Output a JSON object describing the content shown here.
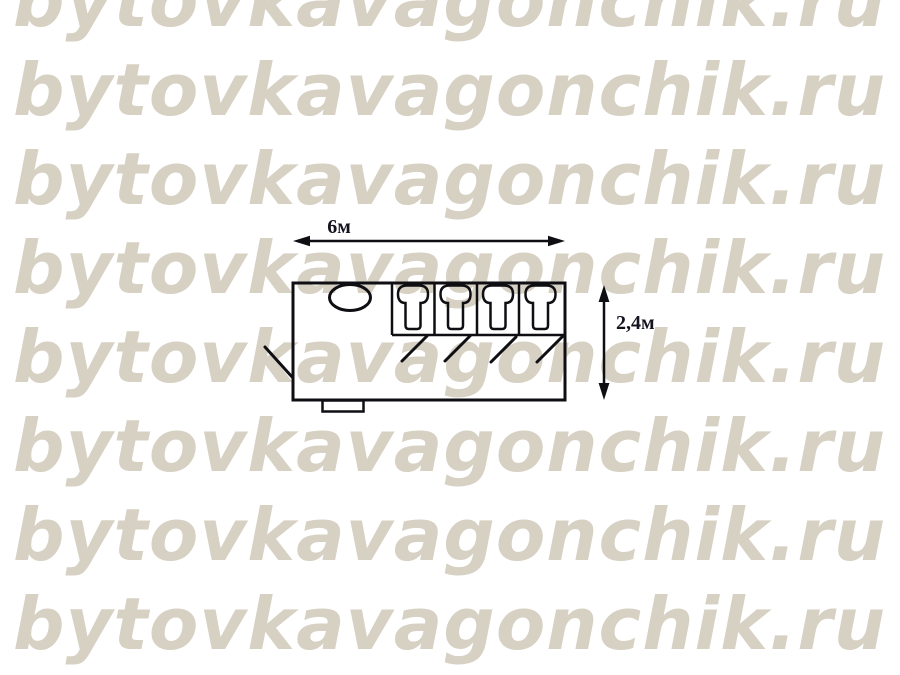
{
  "watermark": {
    "text": "bytovkavagonchik.ru",
    "color": "#d7d1c4",
    "row_count": 8
  },
  "diagram": {
    "width_label": "6м",
    "height_label": "2,4м",
    "ink_color": "#0e0e13",
    "label_color": "#14141f",
    "paper_color": "#ffffff",
    "stall_count": 4,
    "toilet_count": 4,
    "sink_count": 1
  }
}
